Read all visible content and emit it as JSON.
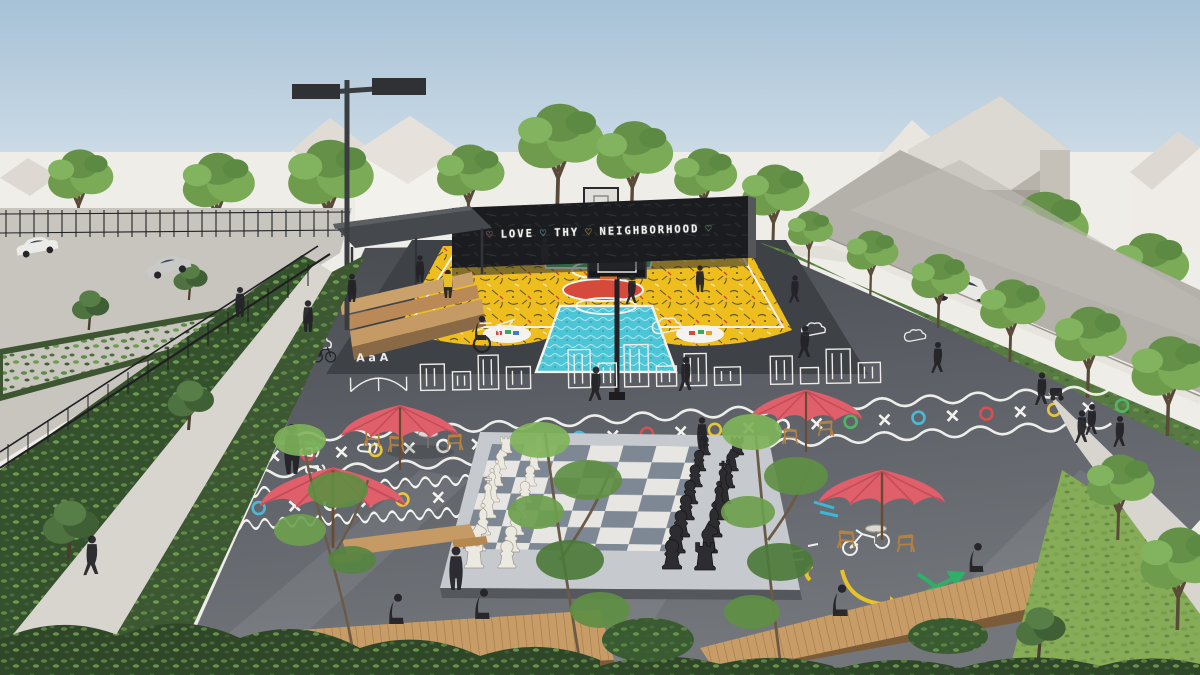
{
  "scene": {
    "description": "Aerial architectural rendering of a neighborhood pocket park: painted basketball court with mural wall, giant chess board, game plaza, cafe umbrellas, benches, parking lot and street",
    "mural": {
      "parts": [
        {
          "text": "♡",
          "color": "#e05252"
        },
        {
          "text": "LOVE",
          "color": "#f4f4f2"
        },
        {
          "text": "♡",
          "color": "#6cc4e0"
        },
        {
          "text": "THY",
          "color": "#e3c43c"
        },
        {
          "text": "♡",
          "color": "#e3c43c"
        },
        {
          "text": "NEIGHBORHOOD",
          "color": "#f4f4f2"
        },
        {
          "text": "♡",
          "color": "#58b86a"
        }
      ],
      "full_text": "♡ LOVE ♡ THY ♡ NEIGHBORHOOD ♡"
    },
    "markings": {
      "letters": "A a A"
    },
    "palette": {
      "sky_top": "#a8c2d6",
      "sky_bottom": "#d9e4ec",
      "backdrop": "#efede8",
      "plaza_asphalt": "#595d62",
      "court_yellow": "#edbe1d",
      "court_red": "#d64a3c",
      "key_green": "#3aa95d",
      "key_cyan": "#4cc5d6",
      "mural_wall_black": "#1b1c1f",
      "umbrella_pink": "#df5f6b",
      "wood": "#c1945f",
      "tree_green": "#6f9c4c",
      "chess_dark_square": "#7e8895",
      "chess_light_square": "#e7e6e2",
      "line_white": "#f2f2ef"
    },
    "counts": {
      "umbrellas": 4,
      "basketball_hoops": 2
    }
  }
}
